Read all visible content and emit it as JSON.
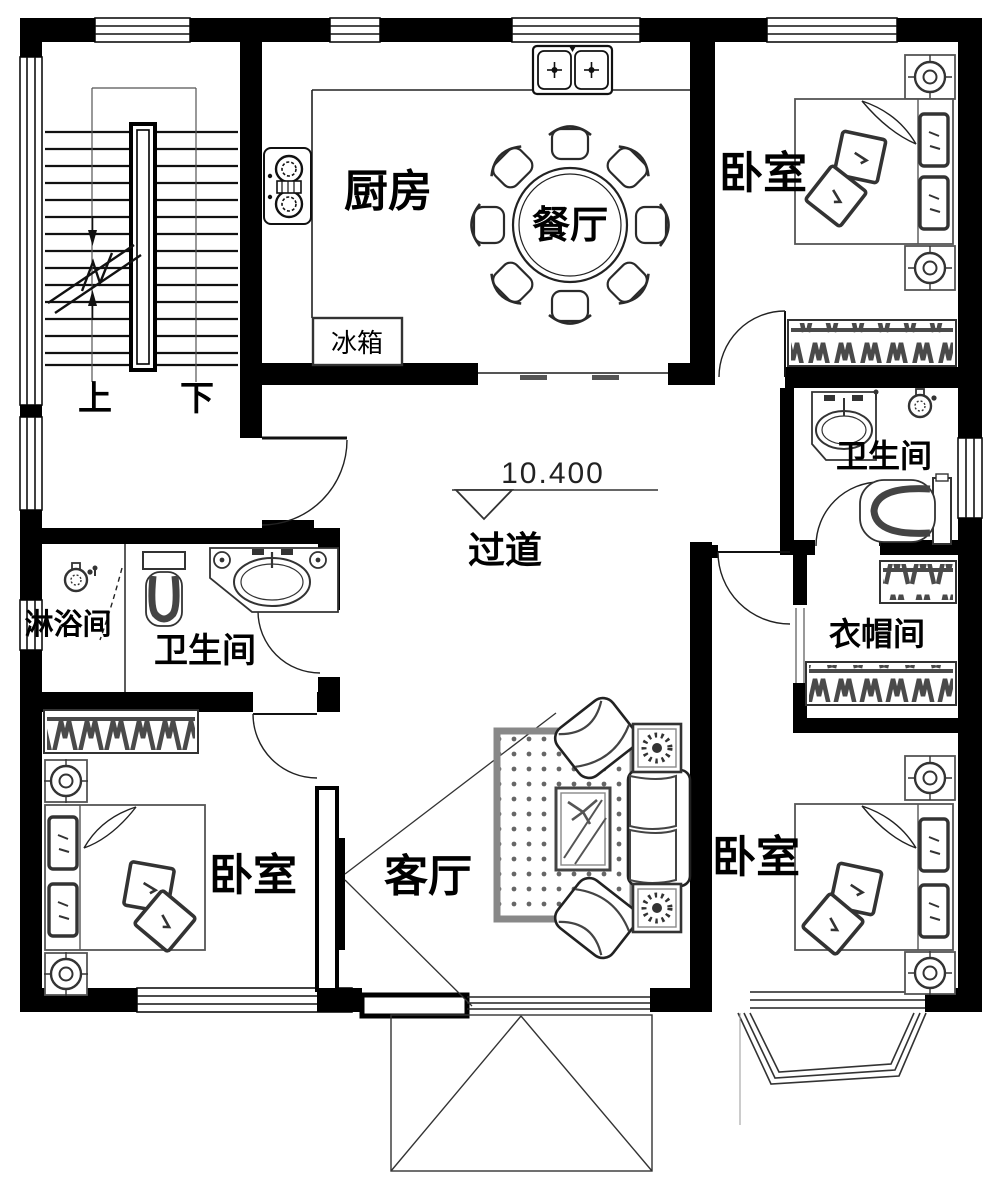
{
  "document": {
    "type": "residential-floor-plan",
    "colors": {
      "wall": "#000000",
      "furniture_line": "#333333",
      "hatch": "#4a4a4a",
      "background": "#ffffff"
    }
  },
  "rooms": {
    "kitchen": {
      "label": "厨房"
    },
    "dining": {
      "label": "餐厅"
    },
    "bedroom_top_right": {
      "label": "卧室"
    },
    "bathroom_right": {
      "label": "卫生间"
    },
    "cloakroom": {
      "label": "衣帽间"
    },
    "corridor": {
      "label": "过道"
    },
    "shower_room": {
      "label": "淋浴间"
    },
    "bathroom_left": {
      "label": "卫生间"
    },
    "bedroom_bottom_left": {
      "label": "卧室"
    },
    "living_room": {
      "label": "客厅"
    },
    "bedroom_bottom_right": {
      "label": "卧室"
    }
  },
  "annotations": {
    "fridge": {
      "label": "冰箱"
    },
    "stairs": {
      "up": "上",
      "down": "下"
    },
    "elevation": {
      "value": "10.400"
    }
  }
}
